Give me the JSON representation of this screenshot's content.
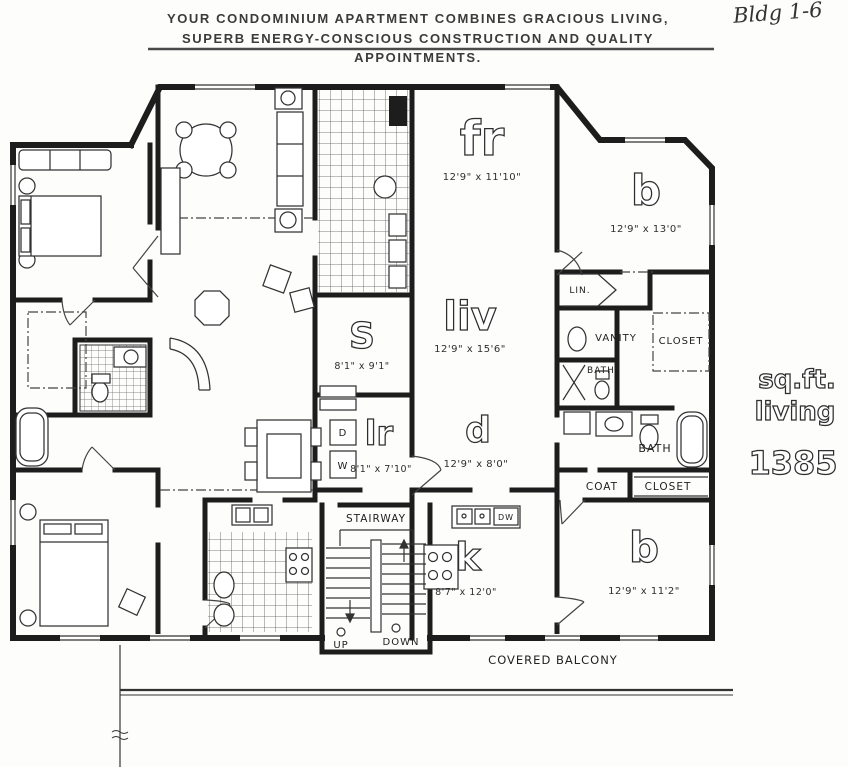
{
  "header": {
    "line1": "YOUR CONDOMINIUM APARTMENT COMBINES GRACIOUS LIVING,",
    "line2": "SUPERB ENERGY-CONSCIOUS CONSTRUCTION AND QUALITY APPOINTMENTS."
  },
  "annotation": {
    "building": "Bldg 1-6"
  },
  "plan": {
    "rooms": {
      "family_room": {
        "label": "fr",
        "dims": "12'9\" x 11'10\""
      },
      "bedroom_top": {
        "label": "b",
        "dims": "12'9\" x 13'0\""
      },
      "living": {
        "label": "liv",
        "dims": "12'9\" x 15'6\""
      },
      "storage": {
        "label": "S",
        "dims": "8'1\" x 9'1\""
      },
      "dining": {
        "label": "d",
        "dims": "12'9\" x 8'0\""
      },
      "laundry": {
        "label": "lr",
        "dims": "8'1\" x 7'10\""
      },
      "kitchen": {
        "label": "k",
        "dims": "8'7\" x 12'0\""
      },
      "bedroom_bottom": {
        "label": "b",
        "dims": "12'9\" x 11'2\""
      }
    },
    "labels": {
      "lin": "LIN.",
      "vanity": "VANITY",
      "closet_upper": "CLOSET",
      "bath_upper": "BATH",
      "bath_lower": "BATH",
      "coat": "COAT",
      "closet_lower": "CLOSET",
      "stairway": "STAIRWAY",
      "up": "UP",
      "down": "DOWN",
      "dishwasher": "DW",
      "dryer": "D",
      "washer": "W",
      "balcony": "COVERED BALCONY"
    },
    "summary": {
      "sqft_line1": "sq.ft.",
      "sqft_line2": "living",
      "sqft_value": "1385"
    }
  },
  "colors": {
    "ink": "#2b2b2b",
    "paper": "#fdfdfc"
  }
}
